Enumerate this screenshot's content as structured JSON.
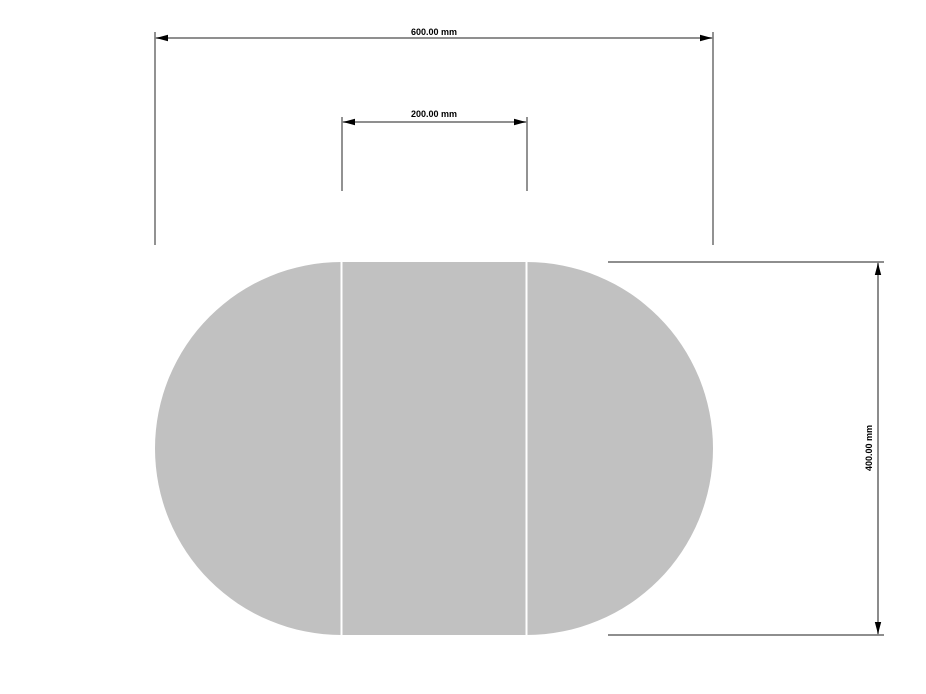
{
  "page": {
    "background": "#ffffff"
  },
  "shape": {
    "name": "oval-table-top",
    "fill": "#c1c1c1",
    "divider_color": "#ffffff",
    "divider_count": 2
  },
  "dimensions": {
    "width": {
      "label": "600.00 mm"
    },
    "inner_section": {
      "label": "200.00 mm"
    },
    "height": {
      "label": "400.00 mm"
    }
  },
  "style": {
    "dimension_line_color": "#7f7f7f",
    "extension_line_color": "#4a4a4a",
    "arrow_color": "#000000",
    "text_color": "#000000"
  }
}
